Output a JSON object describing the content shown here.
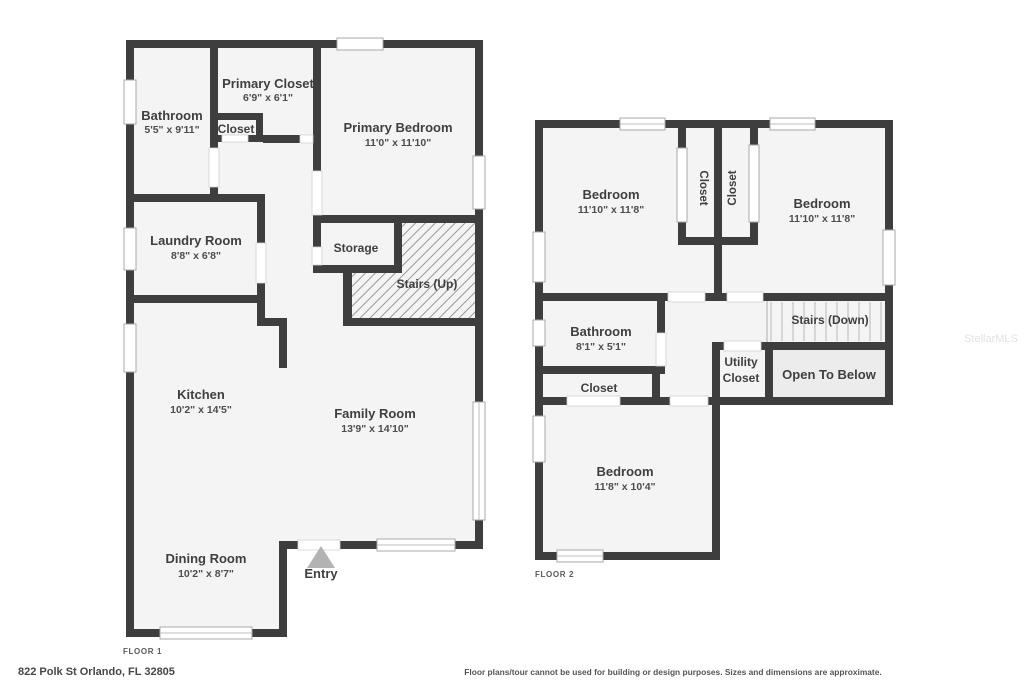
{
  "meta": {
    "address": "822 Polk St Orlando, FL 32805",
    "disclaimer": "Floor plans/tour cannot be used for building or design purposes. Sizes and dimensions are approximate.",
    "watermark": "StellarMLS"
  },
  "floor1": {
    "label": "FLOOR 1",
    "bathroom": {
      "name": "Bathroom",
      "dims": "5'5\" x 9'11\""
    },
    "primary_closet": {
      "name": "Primary Closet",
      "dims": "6'9\" x 6'1\""
    },
    "closet": {
      "name": "Closet"
    },
    "primary_bedroom": {
      "name": "Primary Bedroom",
      "dims": "11'0\" x 11'10\""
    },
    "laundry": {
      "name": "Laundry Room",
      "dims": "8'8\" x 6'8\""
    },
    "storage": {
      "name": "Storage"
    },
    "stairs": {
      "name": "Stairs (Up)"
    },
    "kitchen": {
      "name": "Kitchen",
      "dims": "10'2\" x 14'5\""
    },
    "family": {
      "name": "Family Room",
      "dims": "13'9\" x 14'10\""
    },
    "dining": {
      "name": "Dining Room",
      "dims": "10'2\" x 8'7\""
    },
    "entry": {
      "name": "Entry"
    }
  },
  "floor2": {
    "label": "FLOOR 2",
    "bedroom_left": {
      "name": "Bedroom",
      "dims": "11'10\" x 11'8\""
    },
    "closet_left": {
      "name": "Closet"
    },
    "closet_right": {
      "name": "Closet"
    },
    "bedroom_right": {
      "name": "Bedroom",
      "dims": "11'10\" x 11'8\""
    },
    "bathroom": {
      "name": "Bathroom",
      "dims": "8'1\" x 5'1\""
    },
    "stairs": {
      "name": "Stairs (Down)"
    },
    "utility": {
      "lines": [
        "Utility",
        "Closet"
      ]
    },
    "open_below": {
      "name": "Open To Below"
    },
    "closet_bottom": {
      "name": "Closet"
    },
    "bedroom_bottom": {
      "name": "Bedroom",
      "dims": "11'8\" x 10'4\""
    }
  },
  "colors": {
    "wall": "#3e3e3e",
    "floor_fill": "#f4f4f4",
    "label_text": "#3f3f3f",
    "dim_text": "#4d4d4d",
    "window_stroke": "#a8a8a8",
    "entry_arrow": "#b3b3b3",
    "open_below_fill": "#ececec",
    "watermark": "#e2e2e2"
  }
}
